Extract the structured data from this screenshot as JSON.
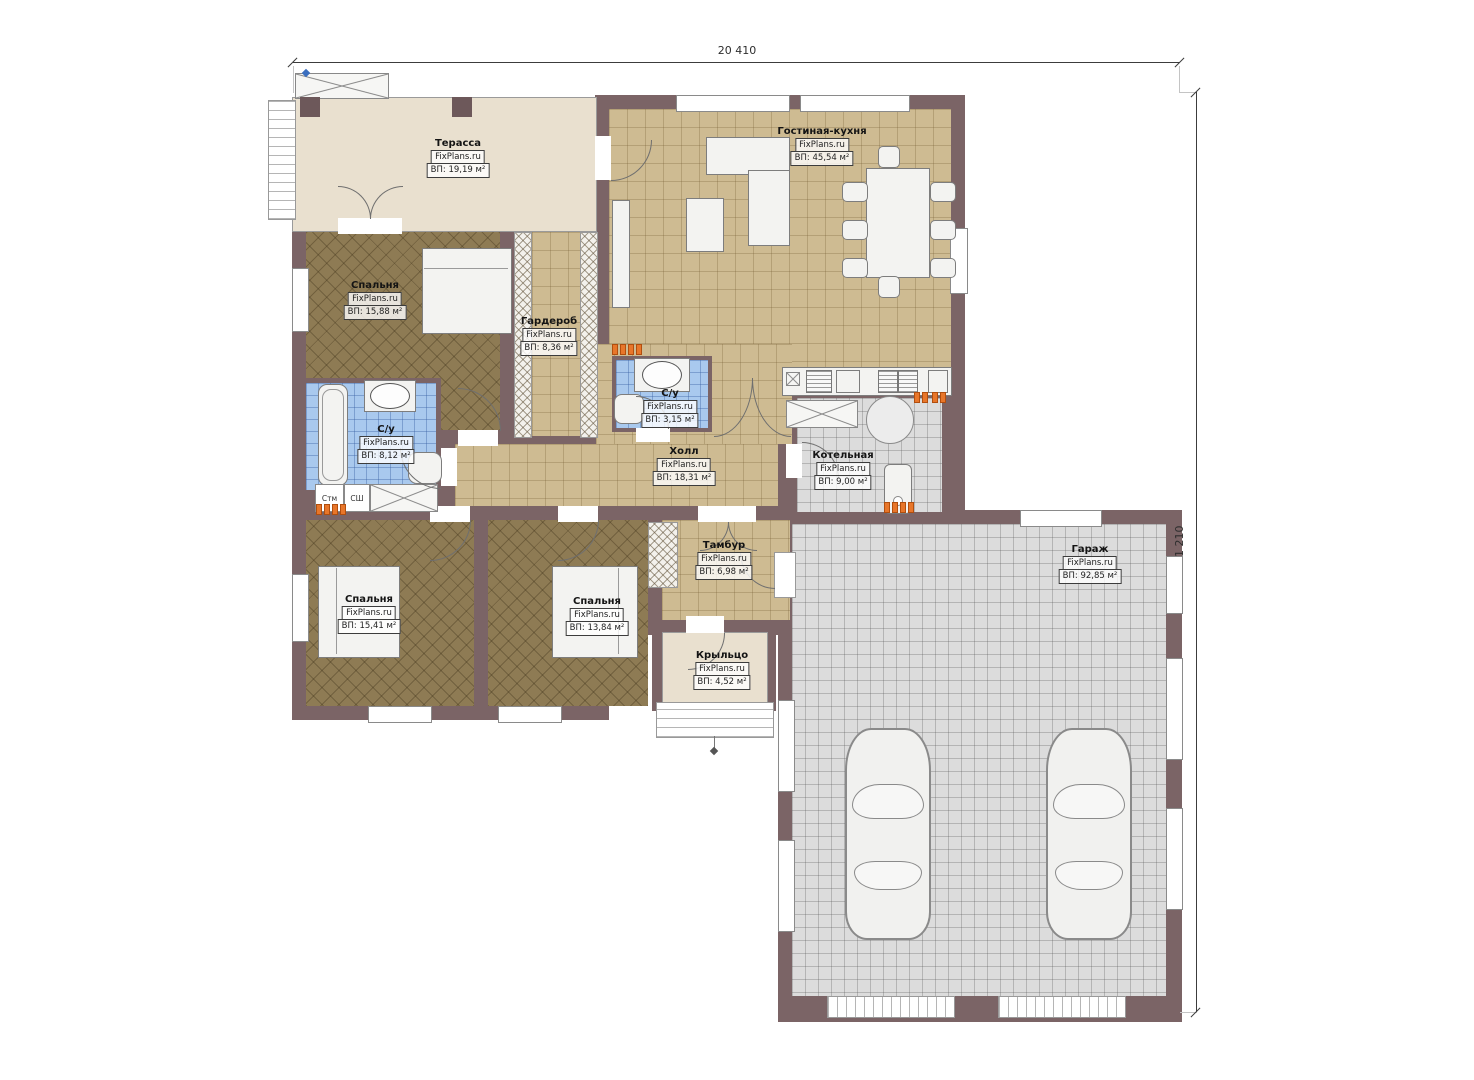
{
  "plan": {
    "title": "План одноэтажного дома",
    "watermark": "FixPlans.ru",
    "dimensions": {
      "top": "20 410",
      "right": "21 210"
    },
    "rooms": [
      {
        "name": "Терасса",
        "area": "ВП: 19,19 м²"
      },
      {
        "name": "Гостиная-кухня",
        "area": "ВП: 45,54 м²"
      },
      {
        "name": "Спальня",
        "area": "ВП: 15,88 м²"
      },
      {
        "name": "Гардероб",
        "area": "ВП: 8,36 м²"
      },
      {
        "name": "С/у",
        "area": "ВП: 3,15 м²"
      },
      {
        "name": "С/у",
        "area": "ВП: 8,12 м²"
      },
      {
        "name": "Холл",
        "area": "ВП: 18,31 м²"
      },
      {
        "name": "Котельная",
        "area": "ВП: 9,00 м²"
      },
      {
        "name": "Тамбур",
        "area": "ВП: 6,98 м²"
      },
      {
        "name": "Спальня",
        "area": "ВП: 15,41 м²"
      },
      {
        "name": "Спальня",
        "area": "ВП: 13,84 м²"
      },
      {
        "name": "Крыльцо",
        "area": "ВП: 4,52 м²"
      },
      {
        "name": "Гараж",
        "area": "ВП: 92,85 м²"
      }
    ],
    "appliances": {
      "washer": "Стм",
      "dryer": "СШ"
    },
    "colors": {
      "wall": "#7b6466",
      "floor_tan": "#cebb92",
      "floor_dark": "#8e7b54",
      "bath_blue": "#a9c9ee",
      "floor_gray": "#dcdcdc",
      "terrace_beige": "#e9e0cf",
      "vent_orange": "#e8762a"
    }
  }
}
